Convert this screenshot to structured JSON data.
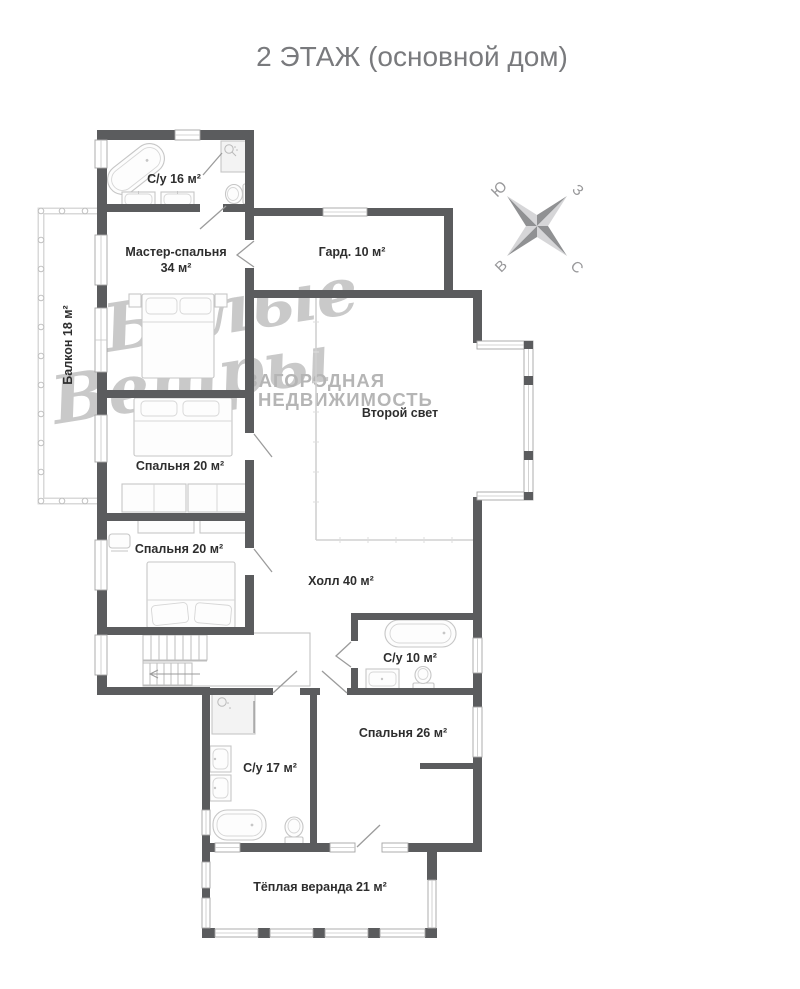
{
  "title": "2 ЭТАЖ (основной дом)",
  "compass": {
    "north": "С",
    "south": "Ю",
    "west": "З",
    "east": "В"
  },
  "watermark": {
    "script_line1": "Белые",
    "script_line2": "Ветры",
    "subtitle_line1": "ЗАГОРОДНАЯ",
    "subtitle_line2": "НЕДВИЖИМОСТЬ"
  },
  "rooms": {
    "bathroom16": {
      "label": "С/у 16 м²"
    },
    "master_bedroom": {
      "label": "Мастер-спальня",
      "area": "34 м²"
    },
    "wardrobe": {
      "label": "Гард. 10 м²"
    },
    "balcony": {
      "label": "Балкон 18 м²"
    },
    "second_light": {
      "label": "Второй свет"
    },
    "bedroom20_1": {
      "label": "Спальня 20 м²"
    },
    "bedroom20_2": {
      "label": "Спальня 20 м²"
    },
    "hall": {
      "label": "Холл 40 м²"
    },
    "bathroom10": {
      "label": "С/у 10 м²"
    },
    "bedroom26": {
      "label": "Спальня 26 м²"
    },
    "bathroom17": {
      "label": "С/у 17 м²"
    },
    "veranda": {
      "label": "Тёплая веранда 21 м²"
    }
  },
  "colors": {
    "wall": "#5b5c5e",
    "window_frame": "#a4a4a4",
    "furniture": "#c6c6c6",
    "label_text": "#2e2e2e",
    "title_text": "#797a7d",
    "watermark": "#bcbcbc",
    "compass_dark": "#909193",
    "compass_light": "#d6d6d8"
  }
}
